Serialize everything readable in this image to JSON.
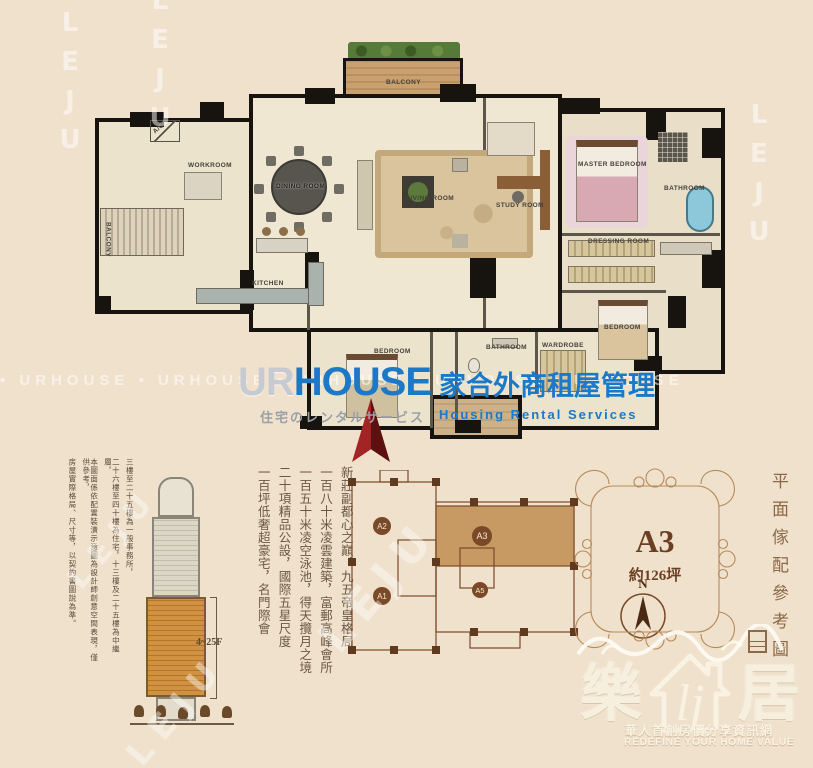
{
  "watermarks": {
    "leju": "LEJU",
    "urhouse_row": "•  URHOUSE        •  URHOUSE        •  URHOUSE        •  URHOUSE        •  URHOUSE"
  },
  "brand": {
    "ur": "UR",
    "house": "HOUSE",
    "cn": "家合外商租屋管理",
    "jp": "住宅のレンタルサービス",
    "en": "Housing  Rental  Services",
    "blue": "#1b79c8",
    "gray": "#9aa0a6"
  },
  "floorplan": {
    "labels": {
      "balcony_top": "BALCONY",
      "ac": "A/C",
      "workroom": "WORKROOM",
      "balcony_left": "BALCONY",
      "kitchen": "KITCHEN",
      "dining": "DINING ROOM",
      "living": "LIVING ROOM",
      "study": "STUDY ROOM",
      "master": "MASTER BEDROOM",
      "master_bath": "BATHROOM",
      "dressing": "DRESSING ROOM",
      "bedroom_right": "BEDROOM",
      "bedroom_mid": "BEDROOM",
      "bath_mid": "BATHROOM",
      "wardrobe": "WARDROBE"
    }
  },
  "disclaimer": {
    "columns": [
      "三樓至二十五樓為一般事務所，",
      "二十六樓至四十樓為住宅，十三樓及二十五樓為中繼層，",
      "本圖面係依配置裝潢示意圖為設計師創意空間表現，僅供參考，",
      "房屋實際格局、尺寸等，以契約書圖說為準。"
    ]
  },
  "marketing": {
    "columns": [
      "新莊副都心之巔，九五帝皇格局",
      "一百八十米凌雲建築，富郵高峰會所",
      "一百五十米凌空泳池，得天攬月之境",
      "二十項精品公設，國際五星尺度",
      "一百坪低奢超豪宅，名門際會"
    ]
  },
  "elevation": {
    "floors": "4~25F"
  },
  "keyplan": {
    "a1": "A1",
    "a2": "A2",
    "a3": "A3",
    "a5": "A5",
    "north": "N",
    "highlight_color": "#c89a63",
    "line_color": "#7a4a28"
  },
  "badge": {
    "unit": "A3",
    "area": "約126坪"
  },
  "side_caption": "平面傢配參考圖",
  "logo": {
    "left": "樂",
    "right": "居",
    "monogram": "lj",
    "tagline_cn": "華人首創房價分享資訊網",
    "tagline_en": "REDEFINE YOUR HOME VALUE"
  }
}
